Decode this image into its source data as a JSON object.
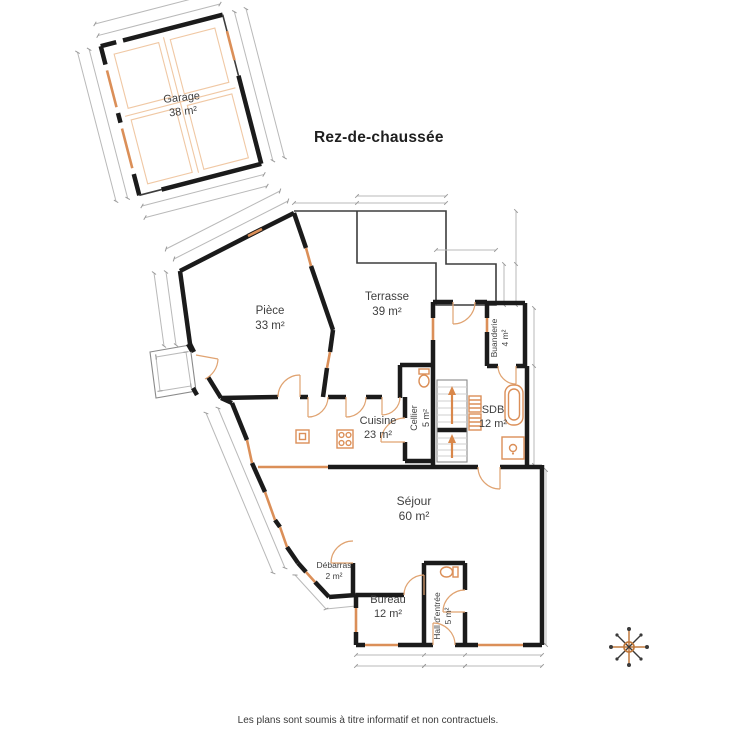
{
  "title": "Rez-de-chaussée",
  "footer": "Les plans sont soumis à titre informatif et non contractuels.",
  "colors": {
    "wall": "#1b1b1b",
    "accent_orange": "#db8f58",
    "accent_orange_light": "#f0c8a4",
    "dimension_gray": "#b9b9b9",
    "label_gray": "#3f3f3f",
    "title_black": "#1f1f1f"
  },
  "rooms": [
    {
      "name": "Garage",
      "area": "38 m²",
      "x": 182,
      "y": 101,
      "rotate": -6,
      "size": 11
    },
    {
      "name": "Pièce",
      "area": "33 m²",
      "x": 270,
      "y": 314,
      "rotate": 0,
      "size": 11.5
    },
    {
      "name": "Terrasse",
      "area": "39 m²",
      "x": 387,
      "y": 300,
      "rotate": 0,
      "size": 11.5
    },
    {
      "name": "Buanderie",
      "area": "4 m²",
      "x": 497,
      "y": 338,
      "rotate": -90,
      "size": 8.5
    },
    {
      "name": "Cuisine",
      "area": "23 m²",
      "x": 378,
      "y": 424,
      "rotate": 0,
      "size": 11
    },
    {
      "name": "Cellier",
      "area": "5 m²",
      "x": 417,
      "y": 418,
      "rotate": -90,
      "size": 9
    },
    {
      "name": "SDB",
      "area": "12 m²",
      "x": 493,
      "y": 413,
      "rotate": 0,
      "size": 11
    },
    {
      "name": "Séjour",
      "area": "60 m²",
      "x": 414,
      "y": 505,
      "rotate": 0,
      "size": 12
    },
    {
      "name": "Débarras",
      "area": "2 m²",
      "x": 334,
      "y": 568,
      "rotate": 0,
      "size": 8.5
    },
    {
      "name": "Bureau",
      "area": "12 m²",
      "x": 388,
      "y": 603,
      "rotate": 0,
      "size": 11
    },
    {
      "name": "Hall d'entrée",
      "area": "5 m²",
      "x": 440,
      "y": 616,
      "rotate": -90,
      "size": 8.5
    }
  ],
  "compass": {
    "icon": "compass-rose-icon",
    "color": "#c07a3e"
  }
}
